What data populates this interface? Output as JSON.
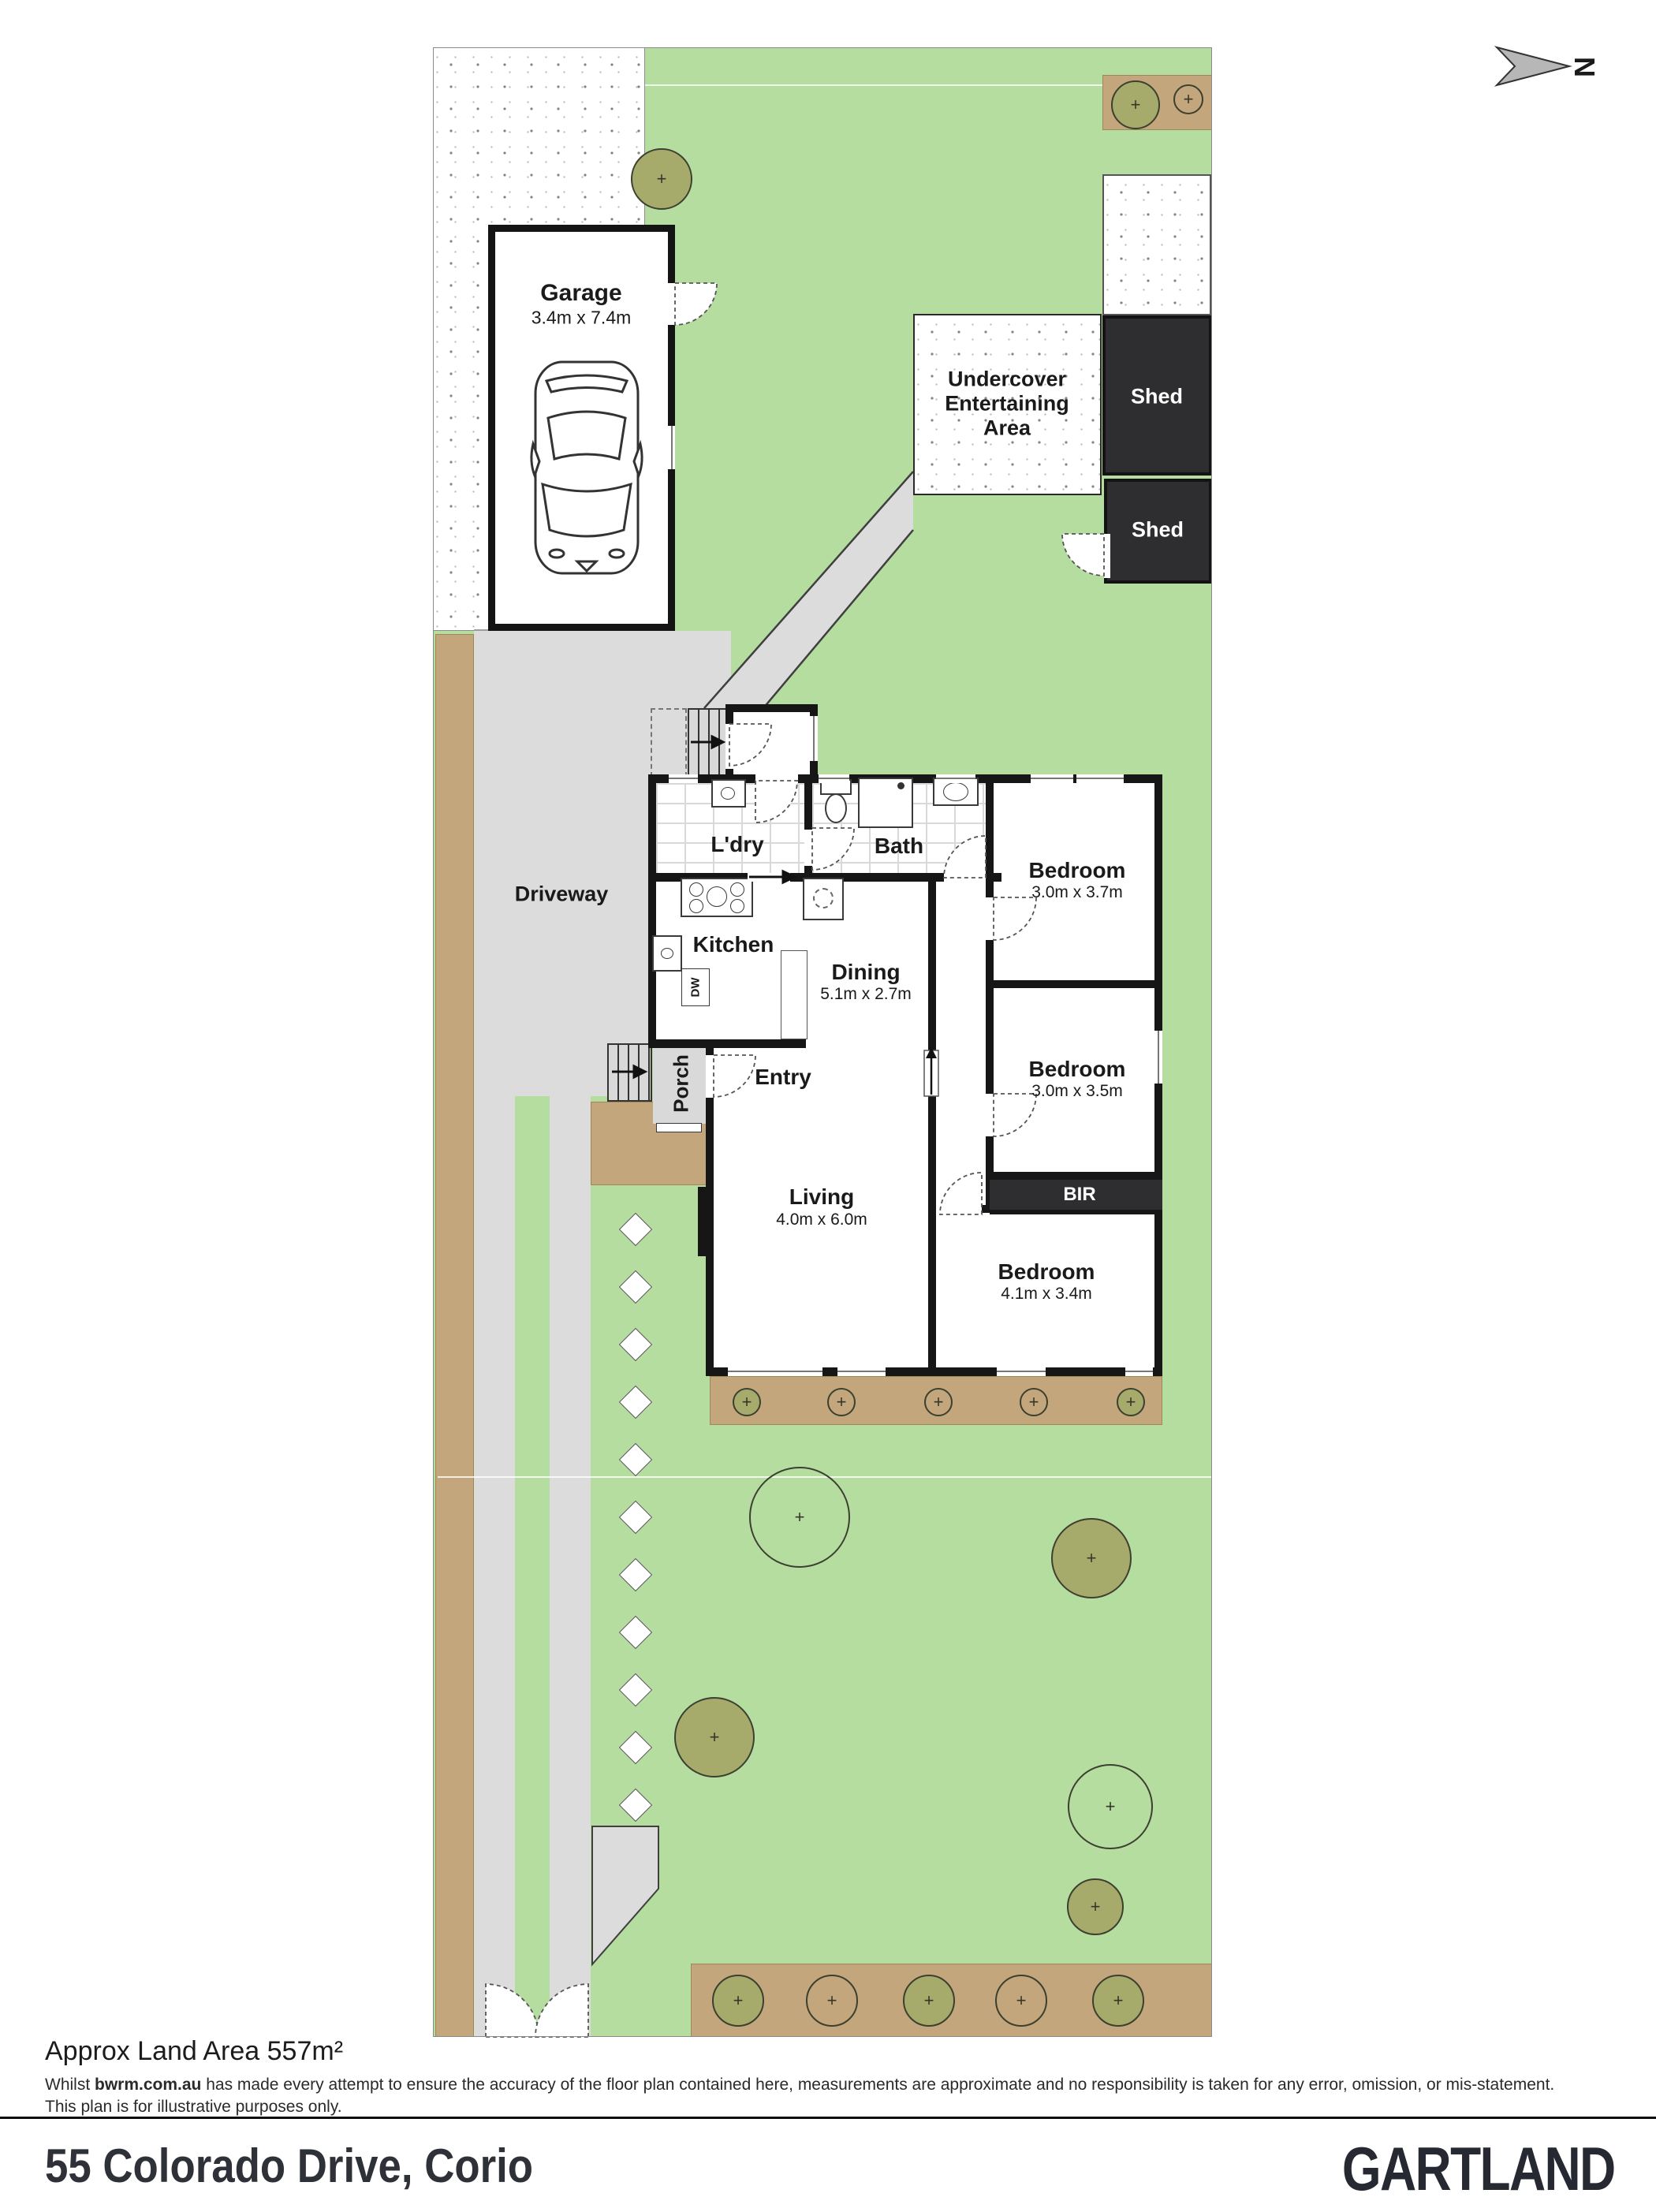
{
  "north_label": "N",
  "rooms": {
    "laundry": {
      "name": "L'dry"
    },
    "bath": {
      "name": "Bath"
    },
    "kitchen": {
      "name": "Kitchen"
    },
    "dining": {
      "name": "Dining",
      "dims": "5.1m x 2.7m"
    },
    "bedroom1": {
      "name": "Bedroom",
      "dims": "3.0m x 3.7m"
    },
    "bedroom2": {
      "name": "Bedroom",
      "dims": "3.0m x 3.5m"
    },
    "bedroom3": {
      "name": "Bedroom",
      "dims": "4.1m x 3.4m"
    },
    "living": {
      "name": "Living",
      "dims": "4.0m x 6.0m"
    },
    "entry": {
      "name": "Entry"
    }
  },
  "outbuildings": {
    "garage_name": "Garage",
    "garage_dims": "3.4m x 7.4m",
    "shed_top": "Shed",
    "shed_bottom": "Shed",
    "uea_line1": "Undercover",
    "uea_line2": "Entertaining",
    "uea_line3": "Area"
  },
  "labels": {
    "driveway": "Driveway",
    "porch": "Porch",
    "bir": "BIR",
    "dw": "DW"
  },
  "footer": {
    "land_area": "Approx Land Area 557m²",
    "disclaimer_prefix": "Whilst ",
    "disclaimer_bold": "bwrm.com.au",
    "disclaimer_rest": " has made every attempt to ensure the accuracy of the floor plan contained here, measurements are approximate and no responsibility is taken for any error, omission, or mis-statement.",
    "disclaimer_line2": "This plan is for illustrative purposes only.",
    "address": "55 Colorado Drive, Corio",
    "brand": "GARTLAND"
  },
  "colors": {
    "lawn": "#b6dda0",
    "driveway": "#dcdcdc",
    "garden_bed": "#c3a67b",
    "shed": "#2e2e30",
    "wall": "#161616",
    "tree_fill": "#a6ab6c",
    "text": "#1a1a1a"
  }
}
